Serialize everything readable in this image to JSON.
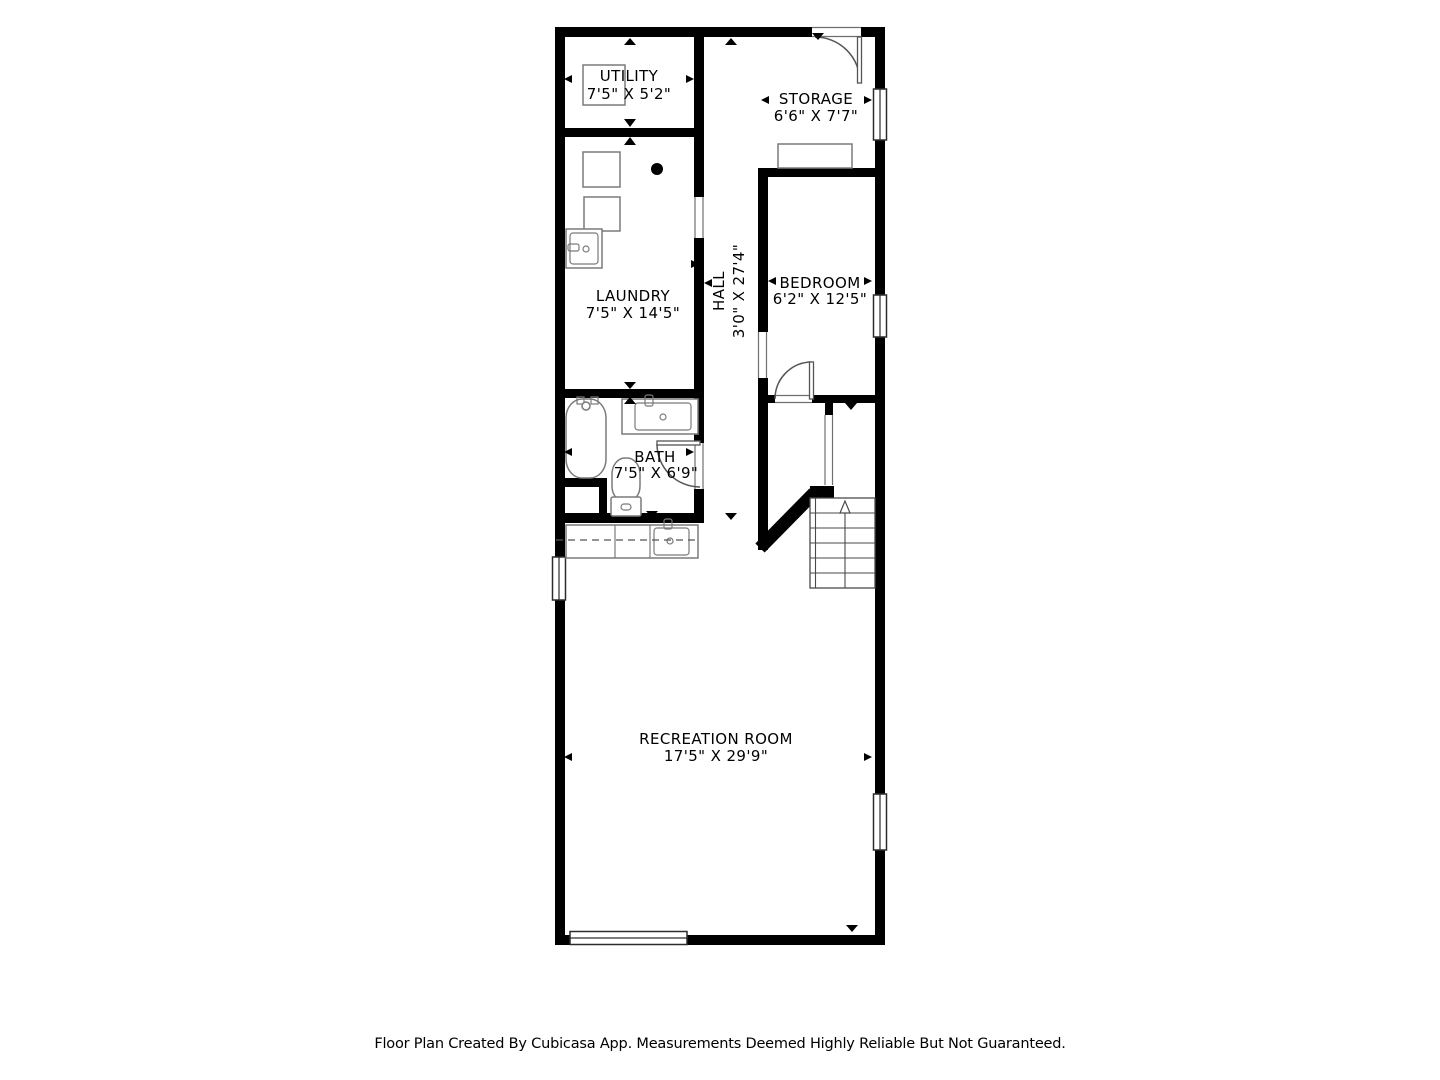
{
  "rooms": [
    {
      "name": "UTILITY",
      "dimensions": "7'5\" X 5'2\""
    },
    {
      "name": "STORAGE",
      "dimensions": "6'6\" X 7'7\""
    },
    {
      "name": "LAUNDRY",
      "dimensions": "7'5\" X 14'5\""
    },
    {
      "name": "HALL",
      "dimensions": "3'0\" X 27'4\""
    },
    {
      "name": "BEDROOM",
      "dimensions": "6'2\" X 12'5\""
    },
    {
      "name": "BATH",
      "dimensions": "7'5\" X 6'9\""
    },
    {
      "name": "RECREATION ROOM",
      "dimensions": "17'5\" X 29'9\""
    }
  ],
  "stairs": {
    "direction": "up"
  },
  "footer": {
    "disclaimer": "Floor Plan Created By Cubicasa App. Measurements Deemed Highly Reliable But Not Guaranteed."
  },
  "colors": {
    "wall": "#000000",
    "background": "#ffffff",
    "fixture_outline": "#7a7a7a",
    "text": "#000000"
  }
}
